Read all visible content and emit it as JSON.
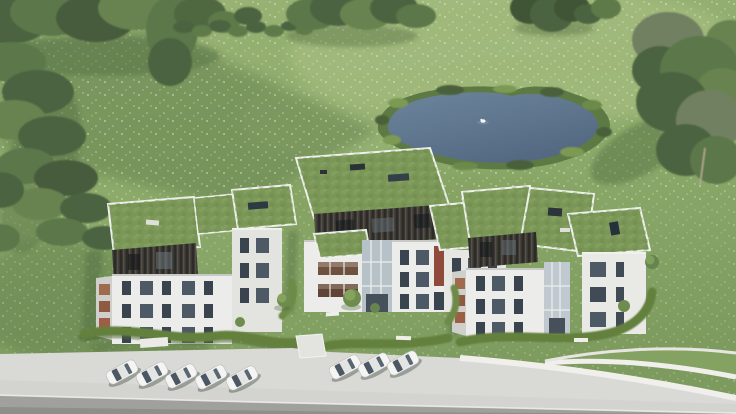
{
  "image": {
    "kind": "3D architectural exterior rendering, aerial bird's-eye view",
    "scene_summary": "Three modern white apartment buildings with planted green flat roofs and dark vertical-slat penthouse levels stand in a large flowering meadow. A reed-edged pond with one white swan lies behind them to the upper right. Dense trees border the left, top and right edges. Wavy hedges, young trees and white benches landscape the gardens. Eight white cars are parked on a light concrete forecourt, with a curving access ramp with white retaining walls at the lower right and a grey road strip along the bottom edge."
  },
  "palette": {
    "meadow_green": "#8caa6a",
    "meadow_light": "#a9c083",
    "grass_shadow": "#5d7a49",
    "tree_dark": "#4c6340",
    "tree_light": "#75905a",
    "pond_water": "#60798f",
    "reed_green": "#5e7a44",
    "facade_white": "#ecedea",
    "facade_shaded": "#cfd0cc",
    "cladding_dark": "#2d2b28",
    "green_roof": "#7a9757",
    "window_glass": "#3a444f",
    "interior_warm": "#a06a4c",
    "pavement": "#d9d9d5",
    "road": "#a0a09c",
    "car_white": "#f4f5f3"
  },
  "elements": {
    "buildings": {
      "count": 3,
      "floors_visible": 3,
      "roof_type": "flat green sedum roofs with skylights",
      "penthouse": "dark vertical-slat cladding",
      "facade": "white render with tall windows, some showing warm interiors"
    },
    "pond": {
      "position": "upper right of centre",
      "swan_count": 1,
      "edge": "reed and shrub fringe"
    },
    "parking": {
      "cars_left_group": 5,
      "cars_right_group": 3,
      "car_color": "white/silver",
      "layout": "echelon parking on concrete apron"
    },
    "vegetation": {
      "tree_borders": [
        "left edge",
        "top edge",
        "right edge"
      ],
      "hedgerow": "dotted shrub row across upper meadow",
      "garden": "wavy hedges, young trees, white benches between buildings"
    },
    "roads": {
      "forecourt": "light concrete parking apron",
      "access": "curved ramp with white retaining walls at lower right",
      "street": "grey road strip along bottom edge"
    }
  }
}
